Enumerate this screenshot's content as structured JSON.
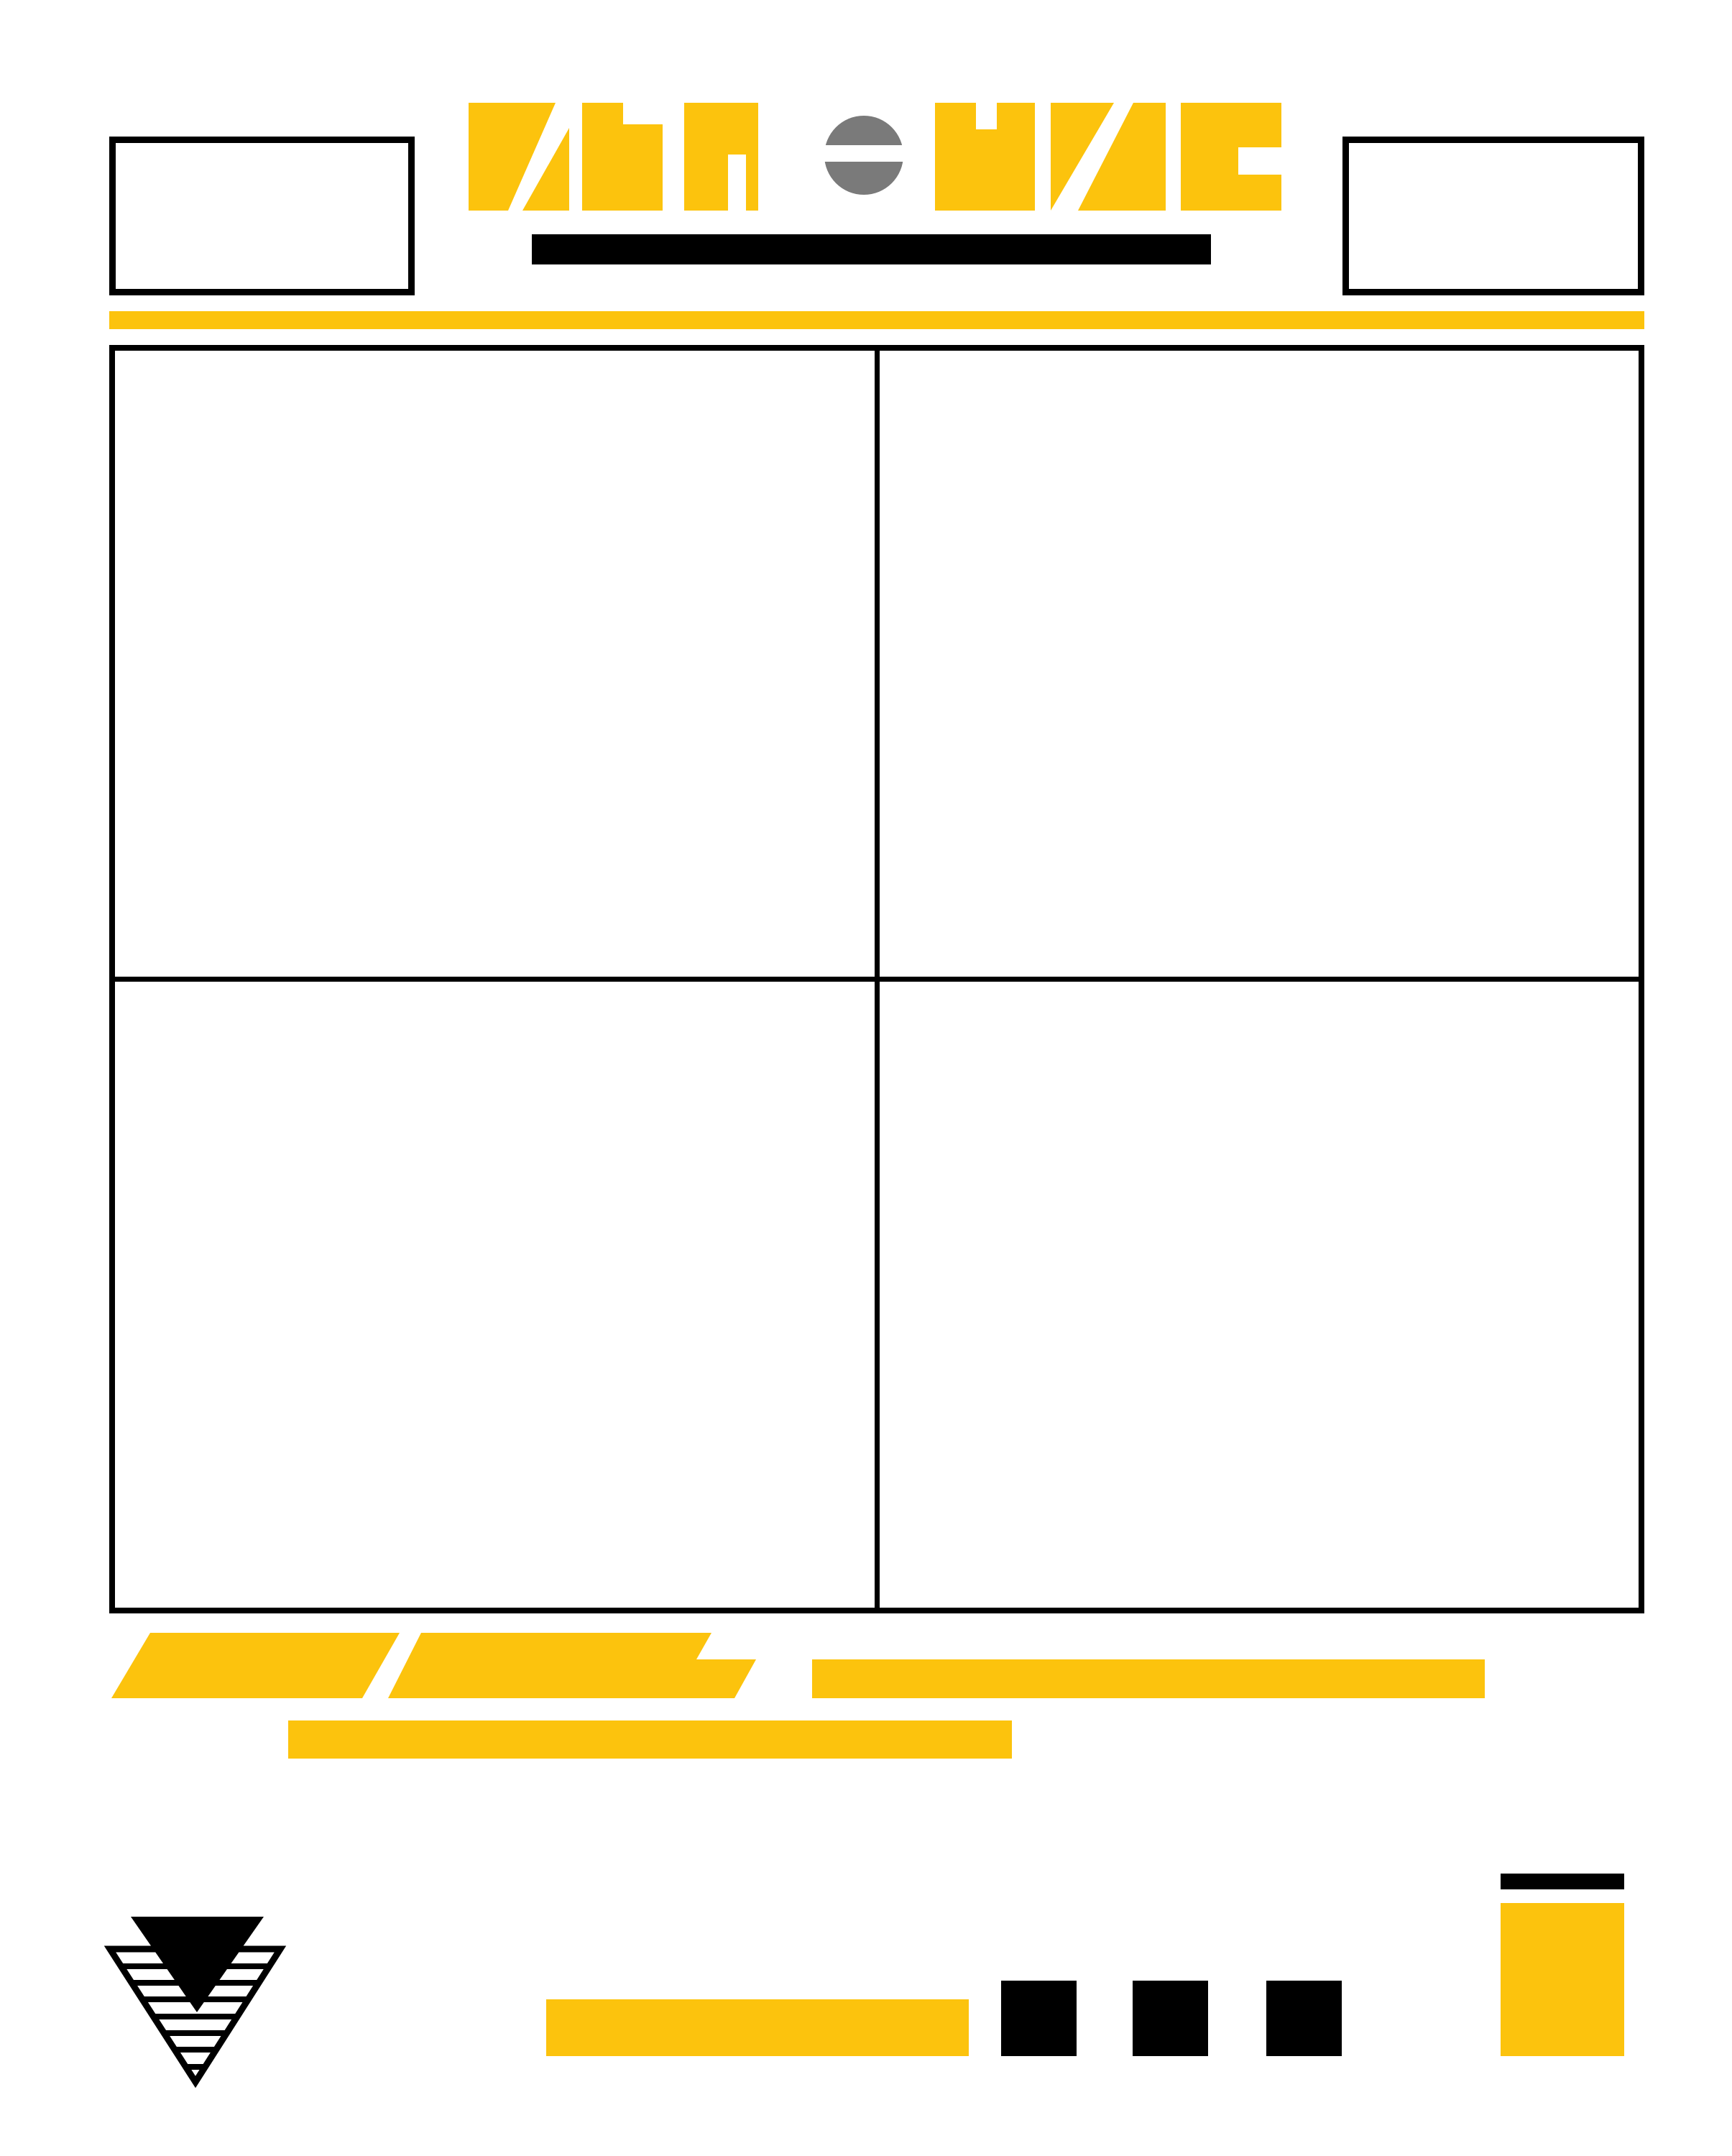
{
  "document": {
    "kind": "poster-page-template",
    "visible_text": "",
    "note": "abstract geometric page layout with no readable text"
  },
  "colors": {
    "yellow": "#FCC30D",
    "ink": "#000000",
    "gray": "#7A7A7A",
    "paper": "#FFFFFF"
  },
  "header": {
    "left_box": "empty outlined rectangle",
    "right_box": "empty outlined rectangle",
    "logotype_glyphs": [
      "slashed-square-glyph",
      "stepped-block-glyph",
      "gated-block-glyph",
      "split-dot-glyph",
      "notched-block-glyph",
      "slashed-pair-glyph",
      "bracket-block-glyph"
    ],
    "underline_bar": "solid black bar under logotype",
    "accent_rule": "full-width yellow rule"
  },
  "panel_grid": {
    "rows": 2,
    "cols": 2,
    "panel_count": 4,
    "panels": [
      {
        "name": "panel-1",
        "content": ""
      },
      {
        "name": "panel-2",
        "content": ""
      },
      {
        "name": "panel-3",
        "content": ""
      },
      {
        "name": "panel-4",
        "content": ""
      }
    ]
  },
  "footer_shapes": {
    "items": [
      "leaning-parallelogram",
      "stepped-parallelogram",
      "long-yellow-strip",
      "second-row-yellow-strip"
    ]
  },
  "brand_mark": {
    "description": "solid black down-triangle overlapping striped outlined down-triangle",
    "stripe_count": 7
  },
  "bottom_row": {
    "yellow_strip": "wide yellow bar",
    "black_squares_count": 3,
    "corner_block": "small black bar above tall yellow block"
  }
}
